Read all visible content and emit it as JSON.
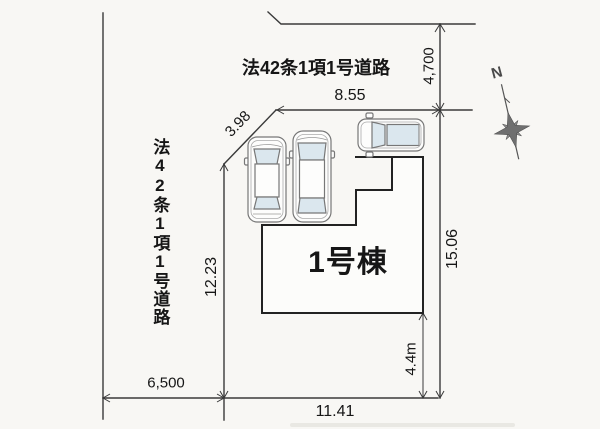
{
  "plan": {
    "building_label": "1号棟",
    "road_label_top": "法42条1項1号道路",
    "road_label_left": "法42条1項1号道路",
    "compass": {
      "north": "N"
    },
    "dims": {
      "road_top_width": "4,700",
      "top_frontage": "8.55",
      "chamfer": "3.98",
      "west_side": "12.23",
      "east_side": "15.06",
      "south_setback": "4.4m",
      "road_left_width": "6,500",
      "south_frontage": "11.41"
    },
    "colors": {
      "line": "#3a3a3a",
      "building_line": "#222222",
      "car_glass": "#dbe7ee",
      "paper": "#f8f7f4"
    }
  }
}
